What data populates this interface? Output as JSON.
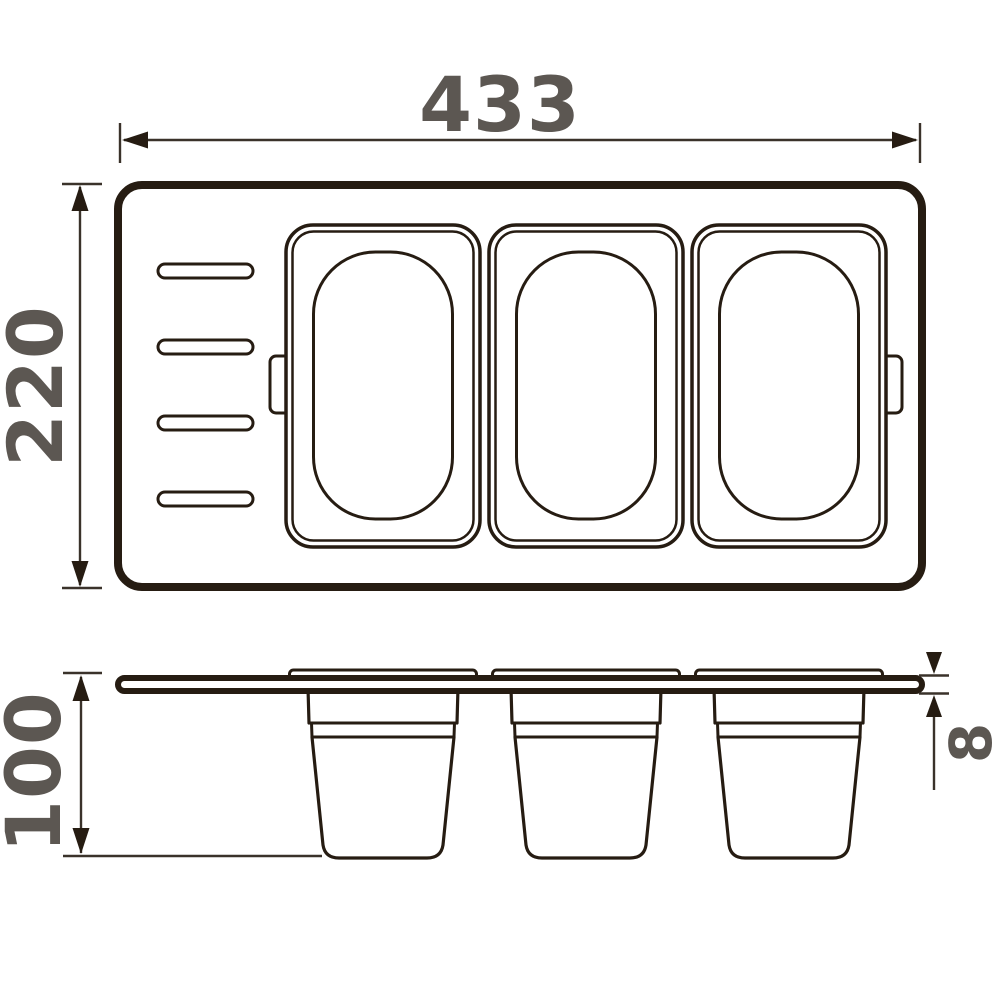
{
  "diagram": {
    "description": "Technical dimension drawing of a kitchen sink tray organizer with three removable containers, shown in top view and side view",
    "dimension_labels": {
      "overall_width": "433",
      "overall_depth": "220",
      "container_height": "100",
      "tray_thickness": "8"
    },
    "top_view": {
      "containers": 3,
      "drain_slots": 4,
      "handle_tabs": 2
    },
    "side_view": {
      "containers": 3,
      "rims": 3
    },
    "colors": {
      "outline": "#261c12",
      "dimension_text": "#5c5752",
      "background": "#ffffff"
    }
  }
}
